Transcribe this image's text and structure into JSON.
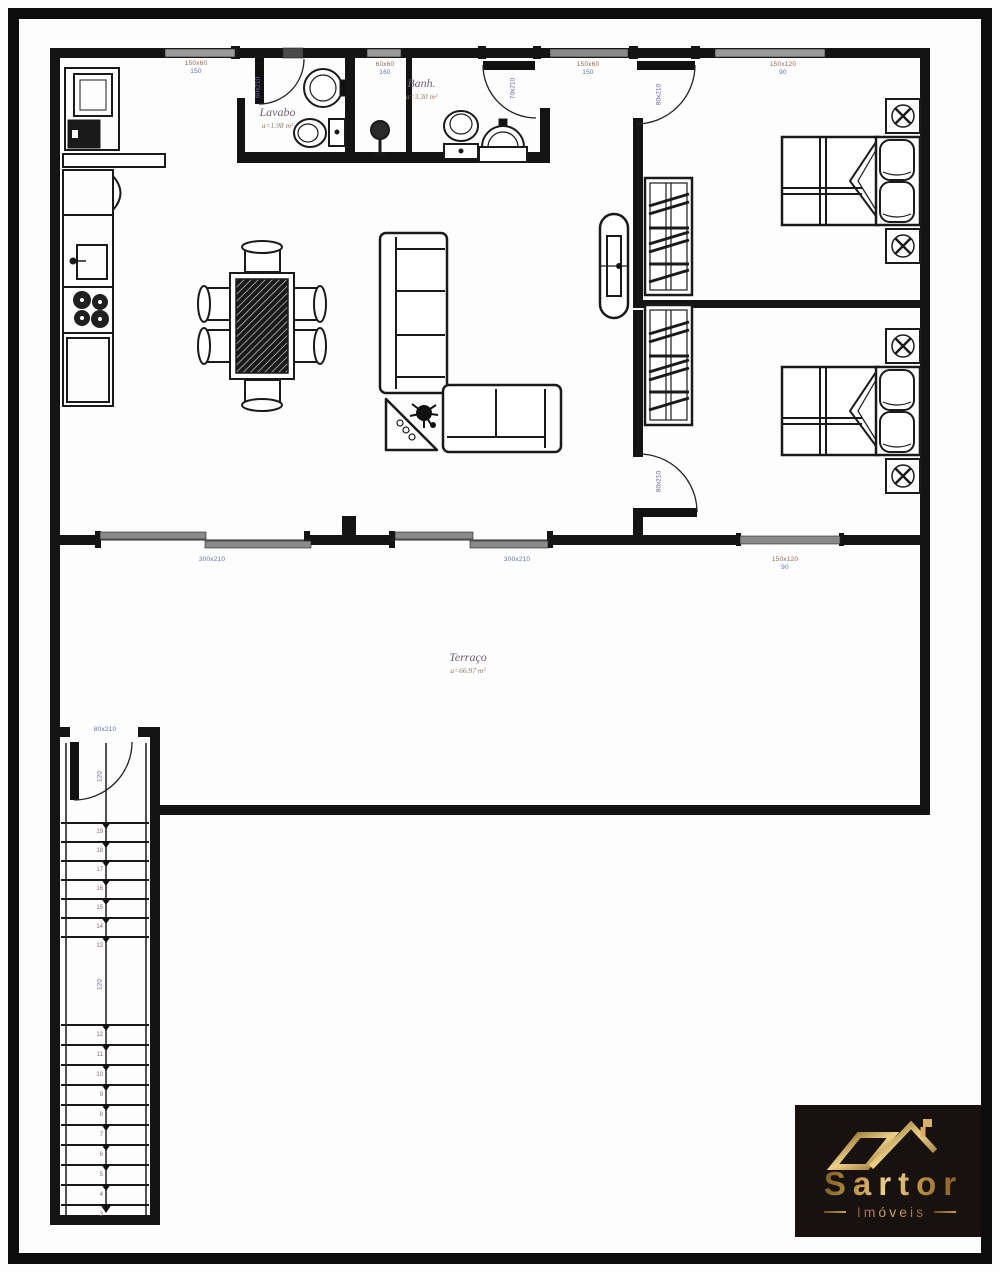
{
  "rooms": {
    "lavabo": {
      "name": "Lavabo",
      "area": "a=1.98 m²"
    },
    "banheiro": {
      "name": "Banh.",
      "area": "a=3.30 m²"
    },
    "terraco": {
      "name": "Terraço",
      "area": "a=66.97 m²"
    }
  },
  "openings": {
    "kitchen_window": {
      "size": "150x60",
      "sill": "150"
    },
    "banh_window": {
      "size": "60x60",
      "sill": "160"
    },
    "hall_window": {
      "size": "150x60",
      "sill": "150"
    },
    "bedroom1_window": {
      "size": "150x120",
      "sill": "90"
    },
    "terrace_window": {
      "size": "150x120",
      "sill": "90"
    },
    "terrace_door_left": {
      "size": "300x210"
    },
    "terrace_door_right": {
      "size": "300x210"
    },
    "lavabo_door": {
      "size": "60x210"
    },
    "banh_door": {
      "size": "70x210"
    },
    "bedroom1_door": {
      "size": "80x210"
    },
    "bedroom2_door": {
      "size": "80x210"
    },
    "stair_door": {
      "size": "80x210"
    }
  },
  "stairs": {
    "width_label": "120",
    "landing_label": "120",
    "upper_step_numbers": [
      "19",
      "18",
      "17",
      "16",
      "15",
      "14",
      "13"
    ],
    "lower_step_numbers": [
      "12",
      "11",
      "10",
      "9",
      "8",
      "7",
      "6",
      "5",
      "4",
      "3"
    ]
  },
  "logo": {
    "brand": "Sartor",
    "tagline": "Imóveis"
  }
}
